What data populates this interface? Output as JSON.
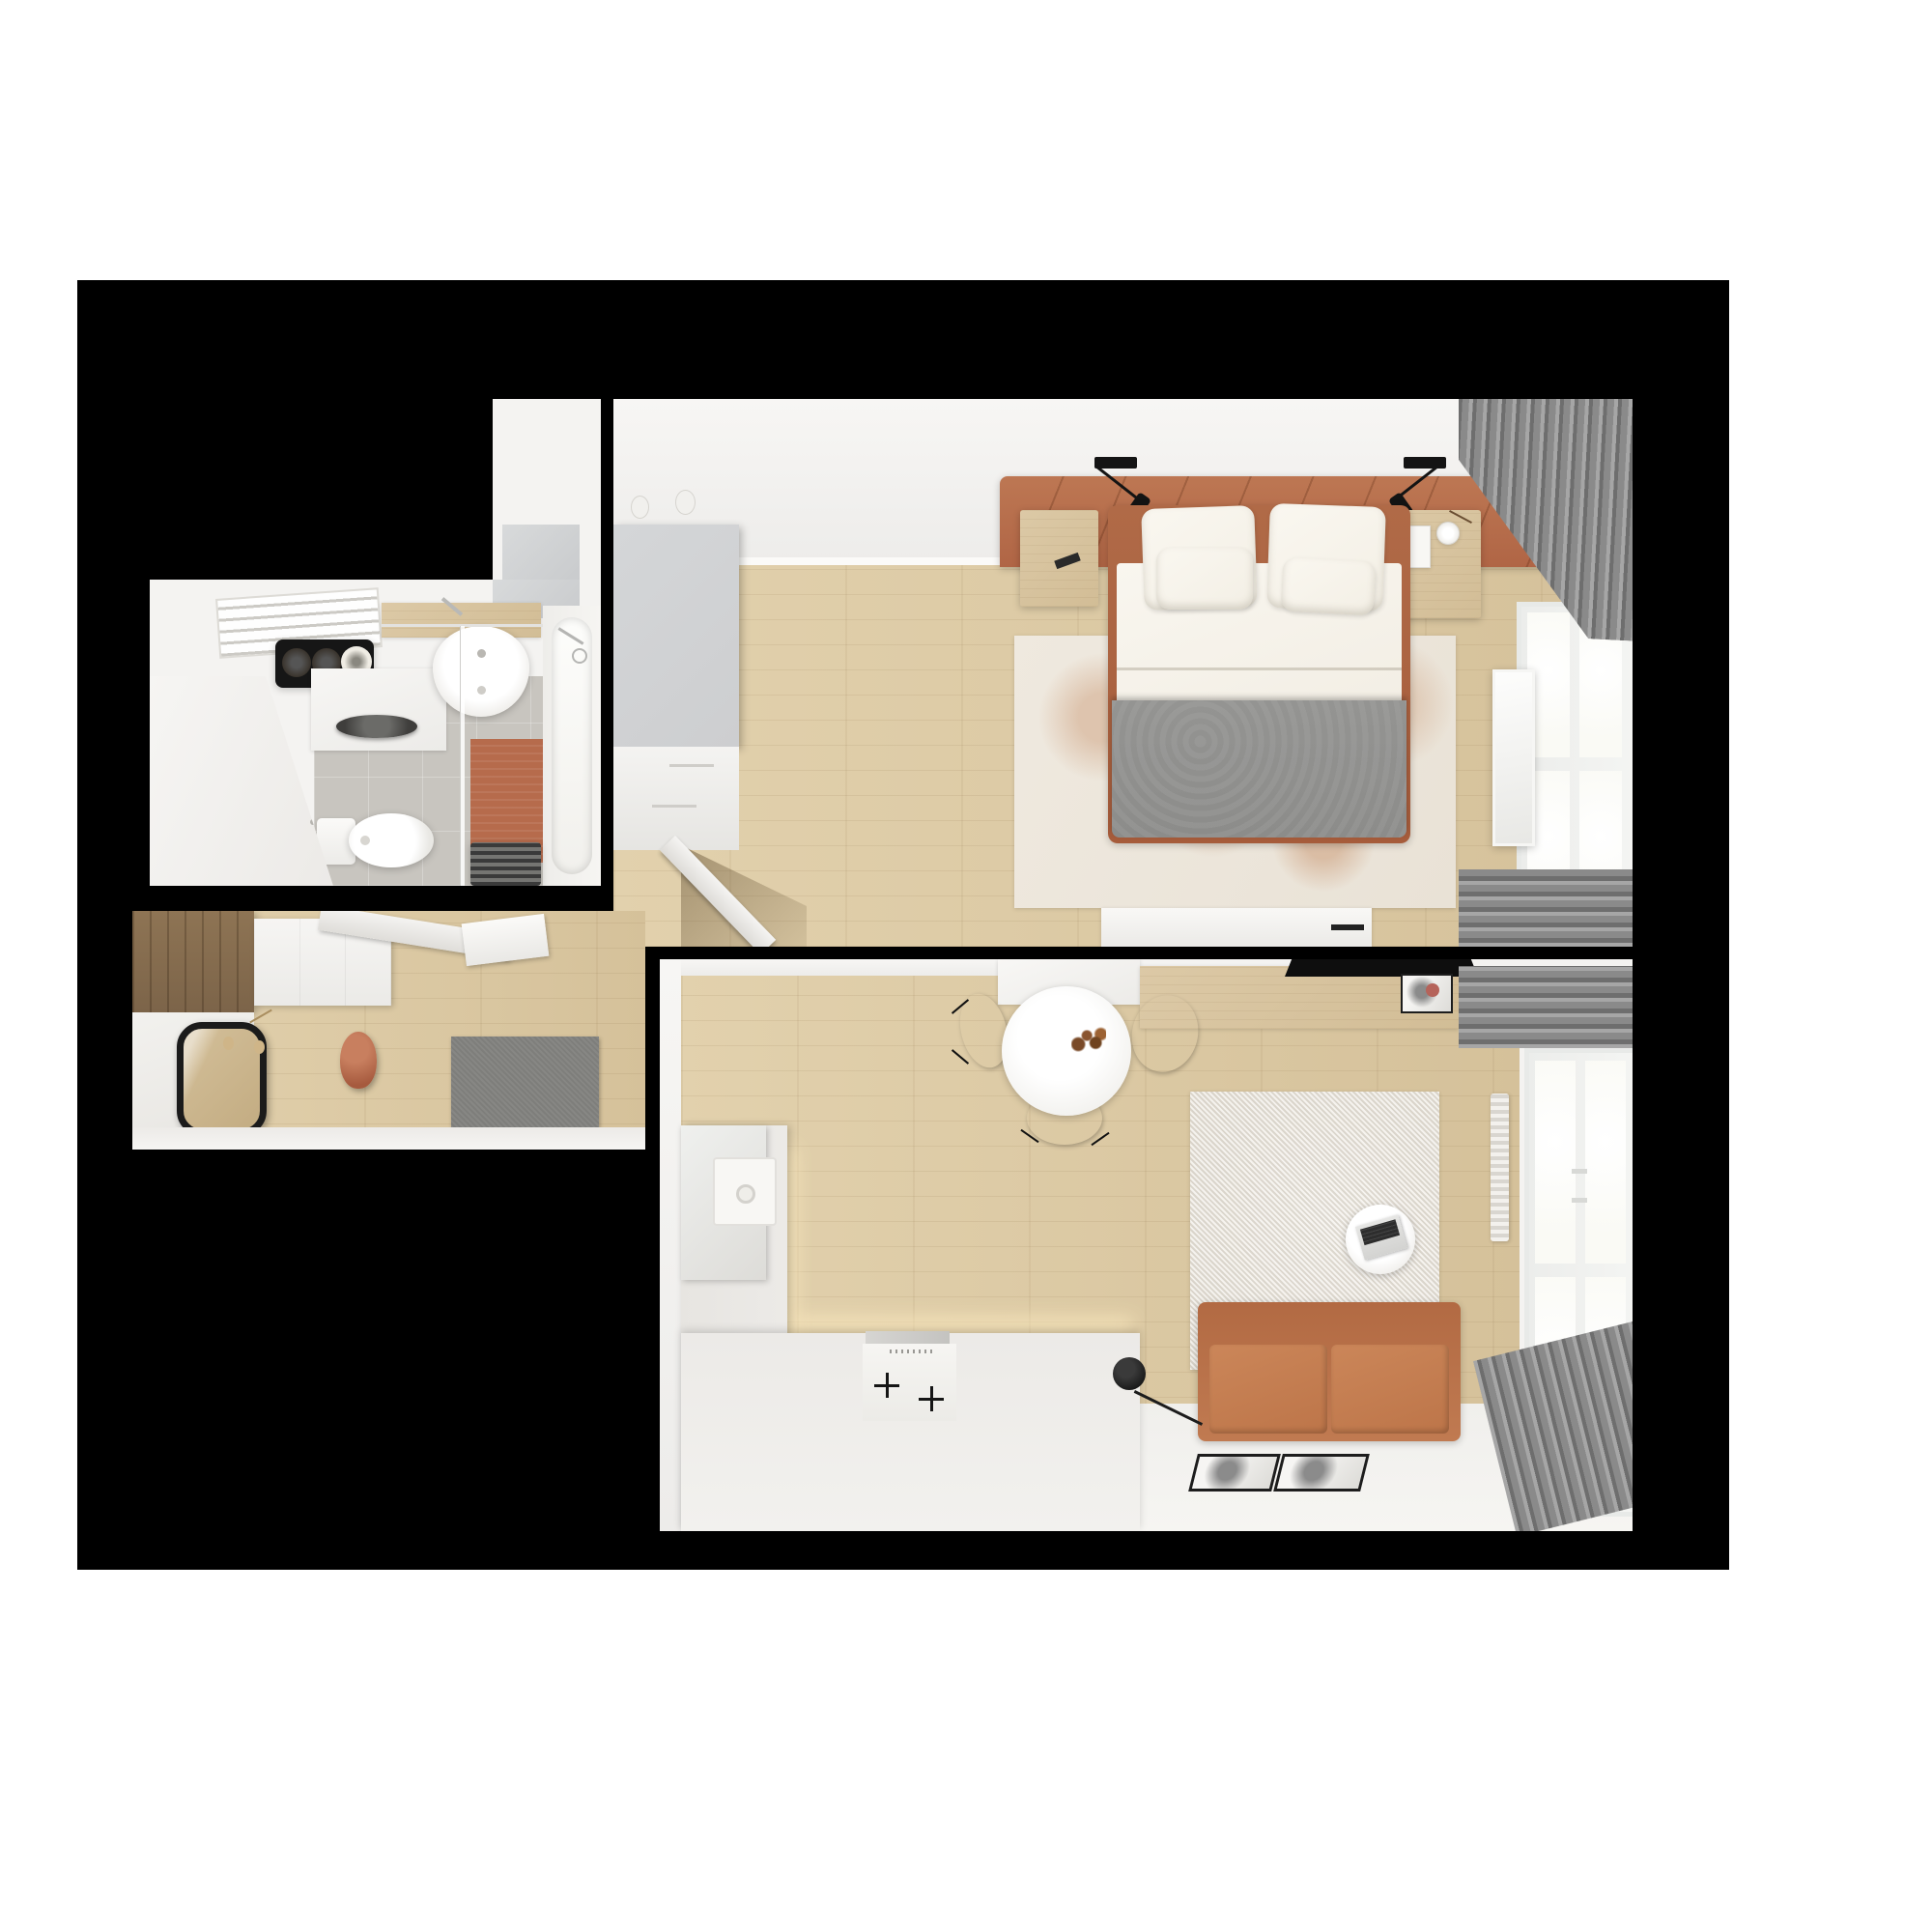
{
  "scene": {
    "title": "top-down-3d-apartment-floor-plan-render",
    "style": "photoreal dollhouse view, four room panels on black backdrop",
    "rooms": [
      {
        "name": "bathroom",
        "position": "upper-left",
        "items": [
          "drying-rack",
          "rolled-towel-shelf",
          "vanity-cabinet",
          "dark-countertop-basin",
          "wood-counter",
          "oval-sink",
          "sink-faucet",
          "shower-rail",
          "glass-partition",
          "toilet",
          "orange-bath-mat",
          "bathtub",
          "tub-faucet",
          "towel-radiator",
          "entry-partition",
          "gray-tile-floor"
        ]
      },
      {
        "name": "bedroom",
        "position": "upper-right",
        "items": [
          "gray-wardrobe",
          "light-switches",
          "leather-headboard",
          "reading-lamp-left",
          "reading-lamp-right",
          "nightstand-left",
          "sunglasses",
          "nightstand-right",
          "book",
          "alarm-clock",
          "double-bed",
          "pillows",
          "white-duvet",
          "gray-blanket",
          "distressed-rug",
          "console-table",
          "open-door",
          "gray-curtains",
          "window",
          "brick-facade",
          "leaning-mirror",
          "wood-floor"
        ]
      },
      {
        "name": "hallway",
        "position": "middle-left",
        "items": [
          "dark-wood-wardrobe",
          "white-closet",
          "open-door-leaf",
          "wall-shelf",
          "round-mirror",
          "key-hooks",
          "terracotta-vase",
          "gray-doormat",
          "wood-floor"
        ]
      },
      {
        "name": "living-room-kitchen",
        "position": "bottom-right",
        "items": [
          "kitchen-upper-cabinet",
          "wood-sideboard",
          "tv-flatscreen",
          "art-frame",
          "dining-table",
          "flower-vase",
          "dining-chairs",
          "l-shaped-kitchen-counter",
          "fridge-column",
          "kitchen-sink",
          "induction-hob",
          "vent-strip",
          "under-cabinet-glow",
          "shag-rug",
          "coffee-table",
          "laptop",
          "leather-sofa",
          "floor-lamp",
          "radiator",
          "window",
          "gray-curtains",
          "leaning-picture-frames",
          "white-floor-zone",
          "wood-floor"
        ]
      }
    ]
  },
  "colors": {
    "backdrop": "#000000",
    "page": "#ffffff",
    "wall": "#f4f3f1",
    "wood_floor": "#e2d1ad",
    "wood_floor_dark": "#d5c19a",
    "wood_furniture": "#dcc9a6",
    "dark_wood": "#8e7454",
    "gray_cabinet": "#cdced0",
    "leather": "#b06545",
    "leather_dark": "#a65c3b",
    "sofa_leather": "#c07a51",
    "blanket_gray": "#8c8c8a",
    "textile_white": "#f3efe5",
    "rug_bedroom": "#e9e2d6",
    "rug_rust": "#c08256",
    "curtain": "#8a8a8a",
    "curtain_dark": "#6e6e6e",
    "glass": "#fafaf5",
    "brick": "#d9c9a3",
    "tile_gray": "#c8c5bf",
    "mat_orange": "#b66b4c",
    "chair_gray": "#98989б",
    "shag_rug": "#eae5dc",
    "counter_white": "#eceae7",
    "black_item": "#161616"
  }
}
